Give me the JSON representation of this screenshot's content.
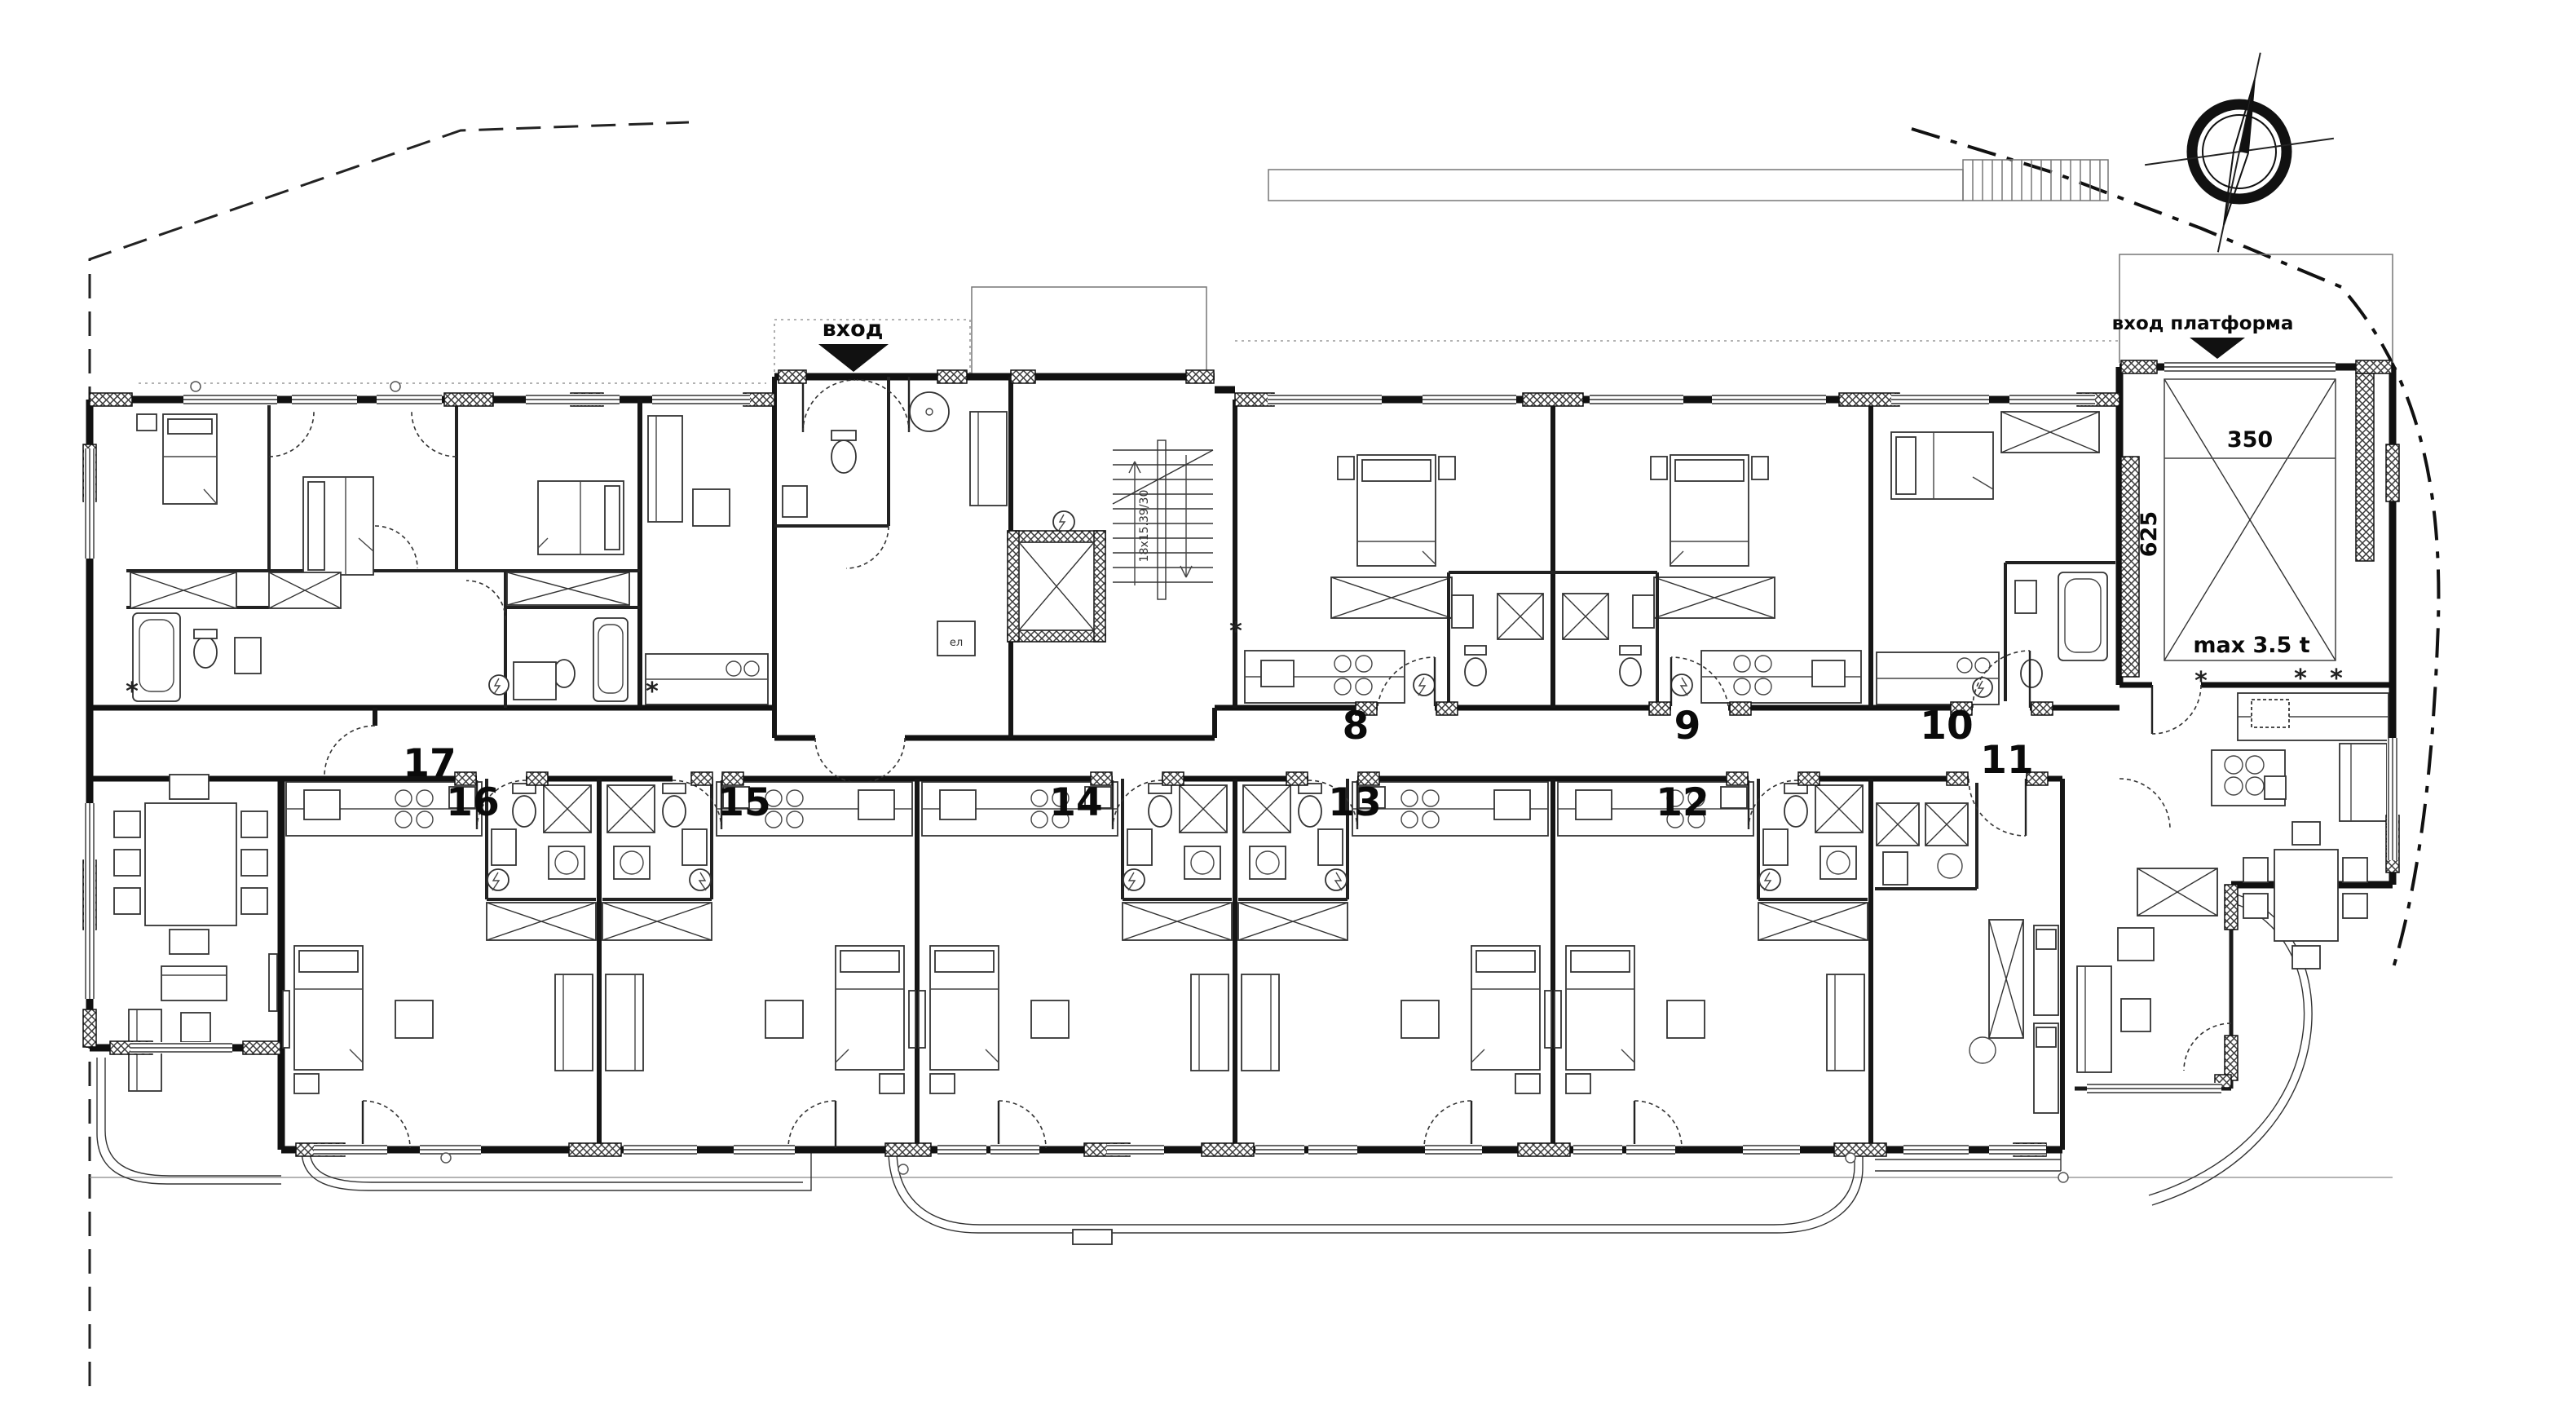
{
  "plan": {
    "entrance_label": "вход",
    "platform_entrance_label": "вход платформа",
    "platform_width": "350",
    "platform_depth": "625",
    "platform_capacity": "max 3.5 t",
    "stairs_dimension": "18x15.39/30",
    "electrical_label": "ел",
    "kitchen_symbol": "*",
    "unit_numbers": [
      "8",
      "9",
      "10",
      "11",
      "12",
      "13",
      "14",
      "15",
      "16",
      "17"
    ]
  },
  "icons": {
    "compass": "north-compass-icon",
    "entrance_arrow": "down-arrow-icon",
    "platform_entrance_arrow": "down-arrow-icon",
    "elevator": "elevator-shaft-icon",
    "stairs": "staircase-icon"
  },
  "colors": {
    "ink": "#111111",
    "paper": "#ffffff",
    "hatch": "#3a3a3a",
    "boundary": "#222222",
    "faint": "#888888"
  }
}
